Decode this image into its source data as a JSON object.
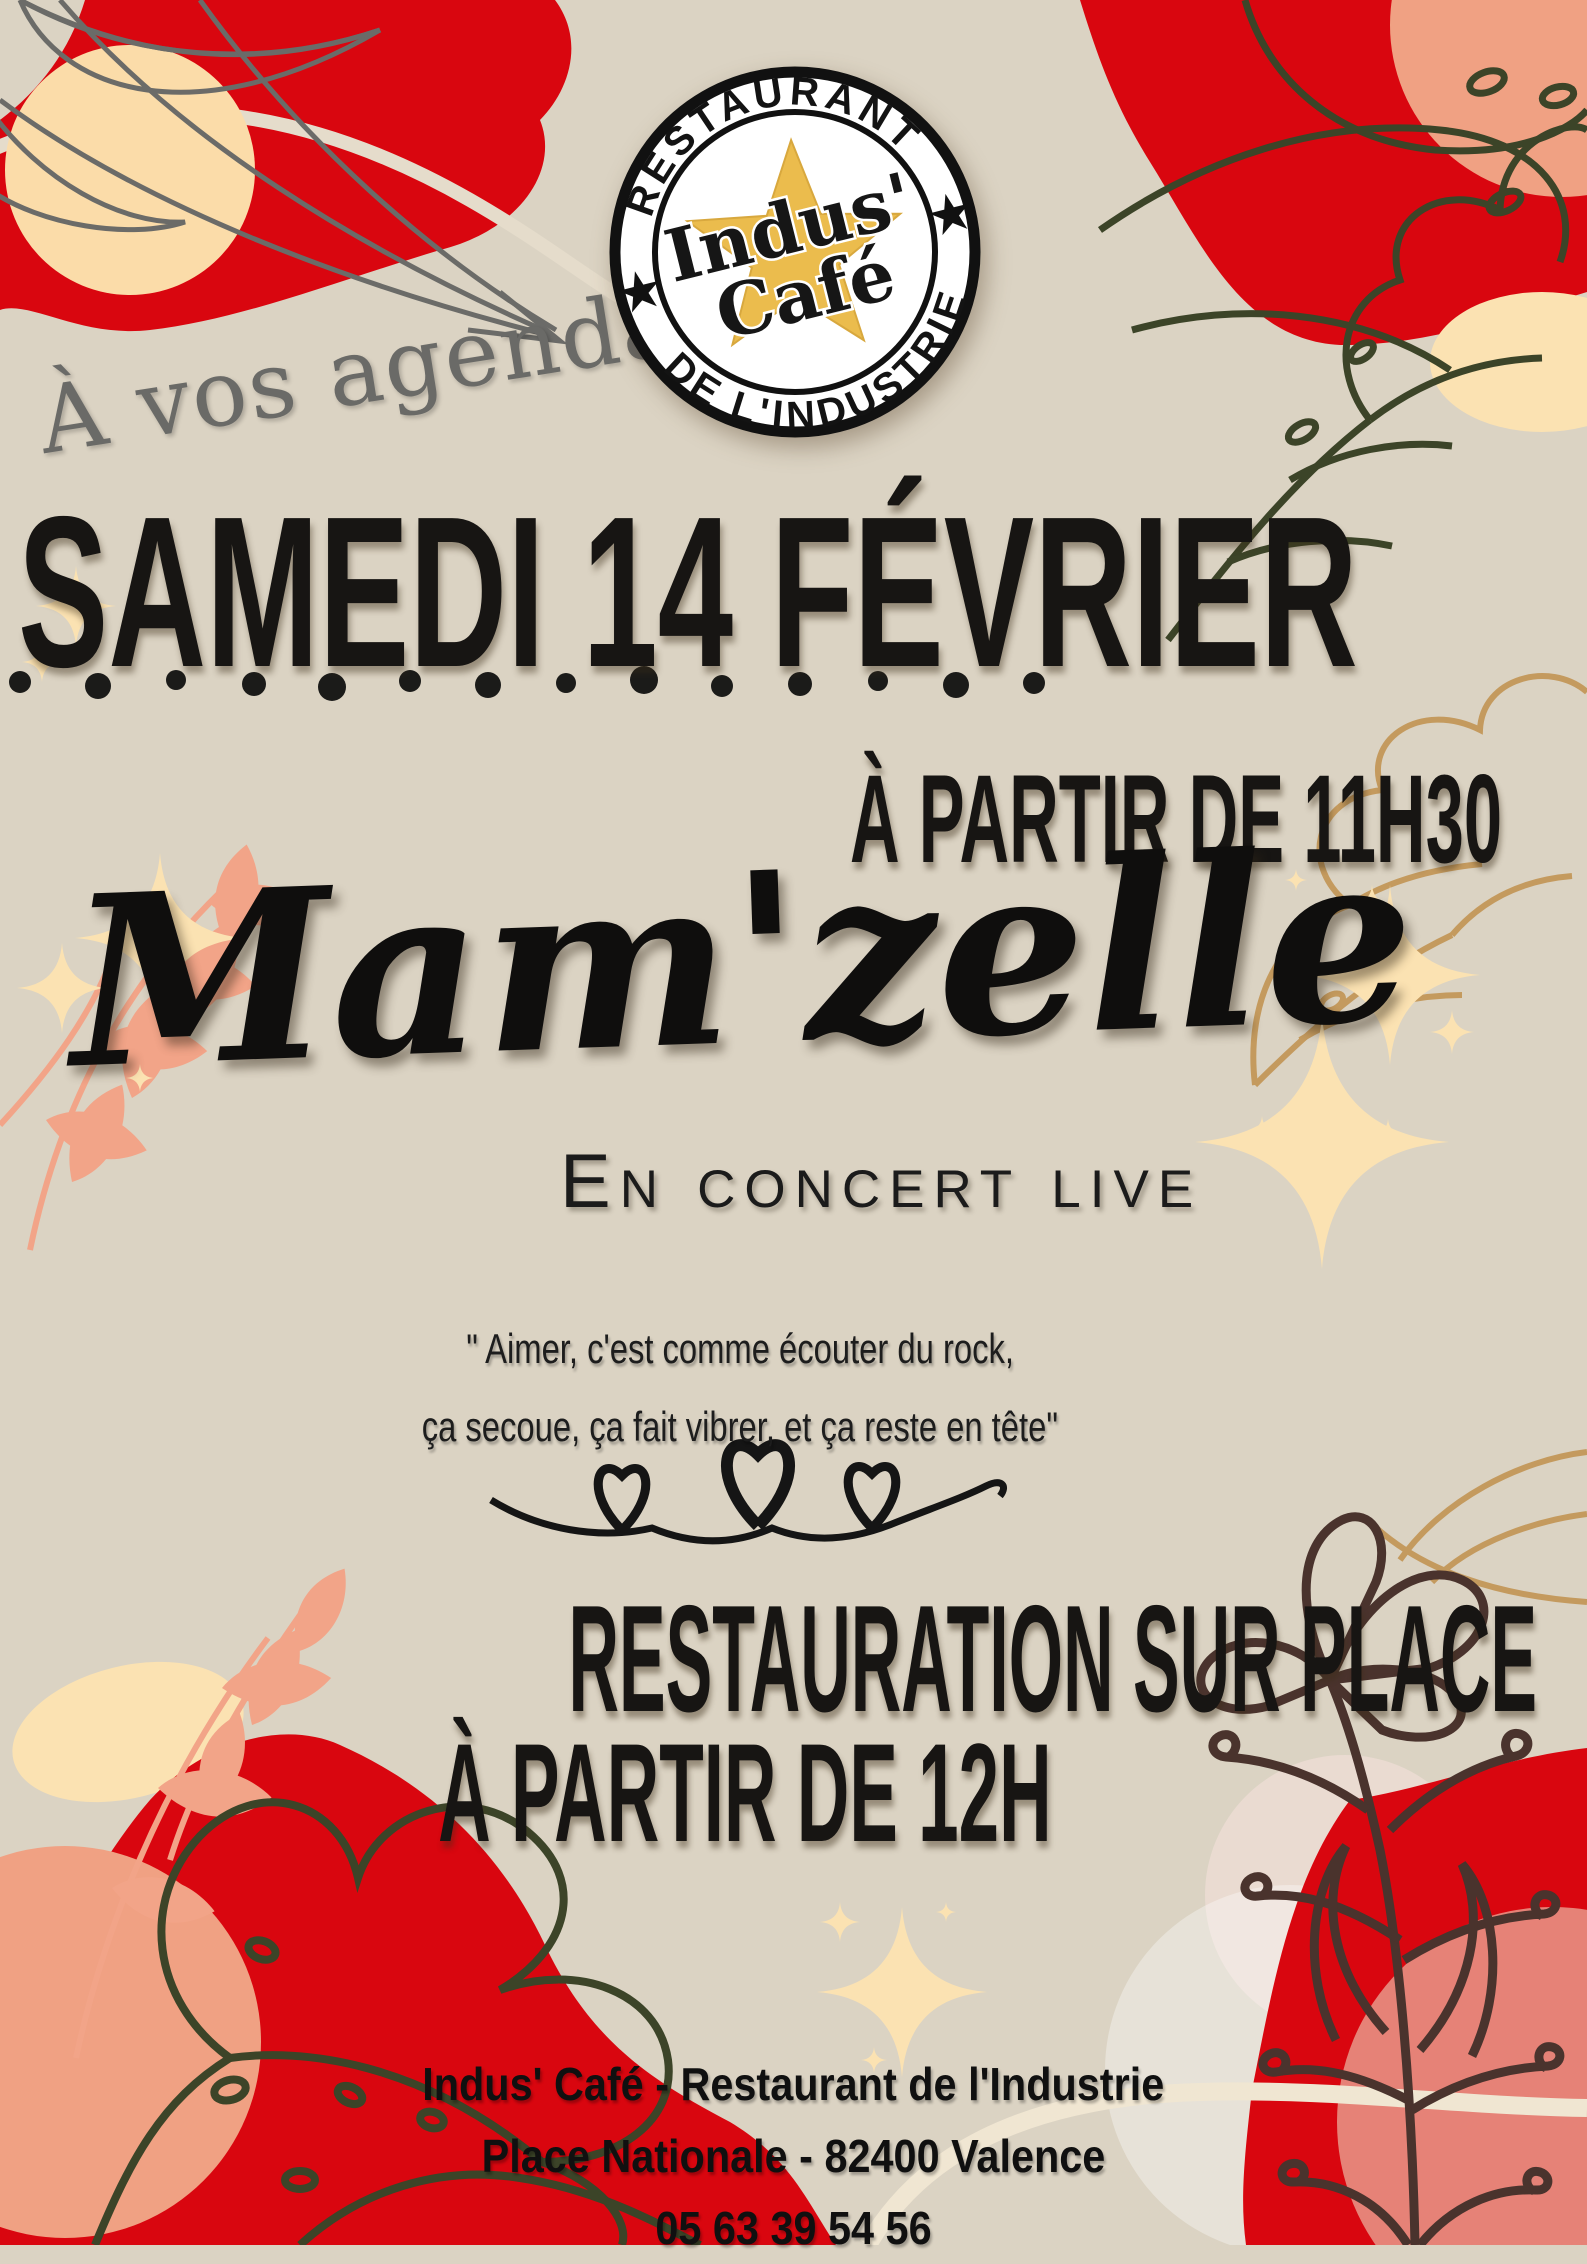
{
  "poster": {
    "badge": {
      "arc_top": "RESTAURANT",
      "arc_bottom": "DE L'INDUSTRIE",
      "name_line1": "Indus'",
      "name_line2": "Café",
      "left_star": "★",
      "right_star": "★"
    },
    "tagline": "À vos agendas !",
    "date_title": "SAMEDI 14 FÉVRIER",
    "time_line": "À PARTIR DE 11H30",
    "artist": "Mam'zelle",
    "subtitle": "En concert live",
    "quote": {
      "line1": "\" Aimer, c'est comme écouter du rock,",
      "line2": "ça secoue, ça fait vibrer, et ça reste en tête\""
    },
    "info": {
      "line1": "RESTAURATION SUR PLACE",
      "line2": "À PARTIR DE 12H"
    },
    "footer": {
      "line1": "Indus' Café - Restaurant de l'Industrie",
      "line2": "Place Nationale - 82400 Valence",
      "line3": "05 63 39 54 56"
    },
    "colors": {
      "background": "#DBD3C3",
      "red": "#D9060F",
      "salmon": "#F0A183",
      "cream": "#FBE2B2",
      "peach_light": "#FBDCA9",
      "green_dark": "#3C4428",
      "tan": "#C49A5E",
      "brown": "#4A332D",
      "gray": "#6B6B68",
      "gold": "#EBBC4D",
      "text_black": "#161616"
    }
  }
}
